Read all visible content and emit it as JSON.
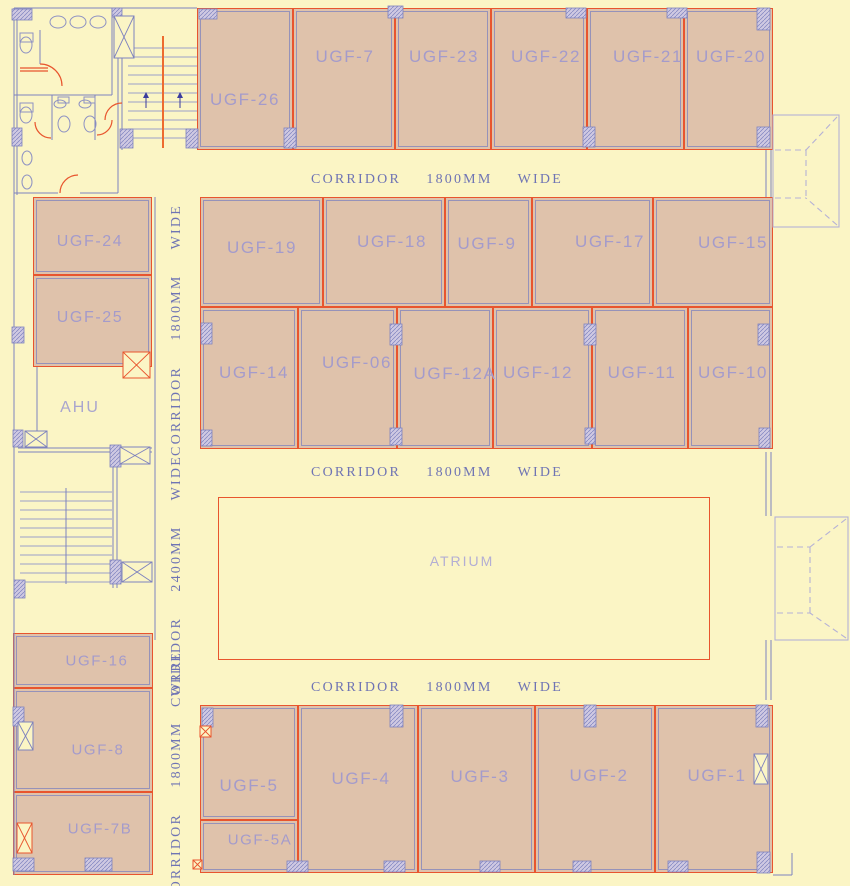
{
  "drawing": {
    "width": 850,
    "height": 886,
    "colors": {
      "background": "#FBF5C5",
      "room_fill": "#DFC2AB",
      "room_stroke": "#E8552E",
      "wall": "#7E82BE",
      "wall_faint": "rgba(126,130,190,0.75)",
      "tread": "#9B9EC9",
      "room_label": "#A49BCB",
      "corridor_label": "#6F74B4",
      "atrium_label": "#B3AED4",
      "ahu_label": "#A9A5CE",
      "column_fill": "#CFC9E2",
      "stair_center": "#ED6B2F",
      "arrow": "#3B3B9E",
      "canopy": "#B5B1D6",
      "fixture": "#8D91C3"
    },
    "rooms": [
      {
        "id": "ugf-26",
        "label": "UGF-26",
        "x": 197,
        "y": 8,
        "w": 96,
        "h": 142,
        "lx": 245,
        "ly": 100
      },
      {
        "id": "ugf-7",
        "label": "UGF-7",
        "x": 293,
        "y": 8,
        "w": 102,
        "h": 142,
        "lx": 345,
        "ly": 57
      },
      {
        "id": "ugf-23",
        "label": "UGF-23",
        "x": 395,
        "y": 8,
        "w": 96,
        "h": 142,
        "lx": 444,
        "ly": 57
      },
      {
        "id": "ugf-22",
        "label": "UGF-22",
        "x": 491,
        "y": 8,
        "w": 96,
        "h": 142,
        "lx": 546,
        "ly": 57
      },
      {
        "id": "ugf-21",
        "label": "UGF-21",
        "x": 587,
        "y": 8,
        "w": 97,
        "h": 142,
        "lx": 648,
        "ly": 57
      },
      {
        "id": "ugf-20",
        "label": "UGF-20",
        "x": 684,
        "y": 8,
        "w": 89,
        "h": 142,
        "lx": 731,
        "ly": 57
      },
      {
        "id": "ugf-19",
        "label": "UGF-19",
        "x": 200,
        "y": 197,
        "w": 123,
        "h": 110,
        "lx": 262,
        "ly": 248
      },
      {
        "id": "ugf-18",
        "label": "UGF-18",
        "x": 323,
        "y": 197,
        "w": 122,
        "h": 110,
        "lx": 392,
        "ly": 242
      },
      {
        "id": "ugf-9",
        "label": "UGF-9",
        "x": 445,
        "y": 197,
        "w": 87,
        "h": 110,
        "lx": 487,
        "ly": 244
      },
      {
        "id": "ugf-17",
        "label": "UGF-17",
        "x": 532,
        "y": 197,
        "w": 121,
        "h": 110,
        "lx": 610,
        "ly": 242
      },
      {
        "id": "ugf-15",
        "label": "UGF-15",
        "x": 653,
        "y": 197,
        "w": 120,
        "h": 110,
        "lx": 733,
        "ly": 243
      },
      {
        "id": "ugf-14",
        "label": "UGF-14",
        "x": 200,
        "y": 307,
        "w": 98,
        "h": 142,
        "lx": 254,
        "ly": 373
      },
      {
        "id": "ugf-06",
        "label": "UGF-06",
        "x": 298,
        "y": 307,
        "w": 99,
        "h": 142,
        "lx": 357,
        "ly": 363
      },
      {
        "id": "ugf-12a",
        "label": "UGF-12A",
        "x": 397,
        "y": 307,
        "w": 96,
        "h": 142,
        "lx": 455,
        "ly": 374
      },
      {
        "id": "ugf-12",
        "label": "UGF-12",
        "x": 493,
        "y": 307,
        "w": 99,
        "h": 142,
        "lx": 538,
        "ly": 373
      },
      {
        "id": "ugf-11",
        "label": "UGF-11",
        "x": 592,
        "y": 307,
        "w": 96,
        "h": 142,
        "lx": 642,
        "ly": 373
      },
      {
        "id": "ugf-10",
        "label": "UGF-10",
        "x": 688,
        "y": 307,
        "w": 85,
        "h": 142,
        "lx": 733,
        "ly": 373
      },
      {
        "id": "ugf-5",
        "label": "UGF-5",
        "x": 200,
        "y": 705,
        "w": 98,
        "h": 115,
        "lx": 249,
        "ly": 786
      },
      {
        "id": "ugf-5a",
        "label": "UGF-5A",
        "x": 200,
        "y": 820,
        "w": 98,
        "h": 53,
        "lx": 260,
        "ly": 840,
        "fs": 15
      },
      {
        "id": "ugf-4",
        "label": "UGF-4",
        "x": 298,
        "y": 705,
        "w": 120,
        "h": 168,
        "lx": 361,
        "ly": 779
      },
      {
        "id": "ugf-3",
        "label": "UGF-3",
        "x": 418,
        "y": 705,
        "w": 117,
        "h": 168,
        "lx": 480,
        "ly": 777
      },
      {
        "id": "ugf-2",
        "label": "UGF-2",
        "x": 535,
        "y": 705,
        "w": 120,
        "h": 168,
        "lx": 599,
        "ly": 776
      },
      {
        "id": "ugf-1",
        "label": "UGF-1",
        "x": 655,
        "y": 705,
        "w": 118,
        "h": 168,
        "lx": 717,
        "ly": 776
      },
      {
        "id": "ugf-24",
        "label": "UGF-24",
        "x": 33,
        "y": 197,
        "w": 119,
        "h": 78,
        "lx": 90,
        "ly": 242,
        "fs": 16
      },
      {
        "id": "ugf-25",
        "label": "UGF-25",
        "x": 33,
        "y": 275,
        "w": 119,
        "h": 92,
        "lx": 90,
        "ly": 318,
        "fs": 16
      },
      {
        "id": "ugf-16",
        "label": "UGF-16",
        "x": 13,
        "y": 633,
        "w": 140,
        "h": 55,
        "lx": 97,
        "ly": 661,
        "fs": 15
      },
      {
        "id": "ugf-8",
        "label": "UGF-8",
        "x": 13,
        "y": 688,
        "w": 140,
        "h": 104,
        "lx": 98,
        "ly": 750,
        "fs": 15
      },
      {
        "id": "ugf-7b",
        "label": "UGF-7B",
        "x": 13,
        "y": 792,
        "w": 140,
        "h": 83,
        "lx": 100,
        "ly": 829,
        "fs": 15
      }
    ],
    "open_areas": [
      {
        "id": "ahu",
        "label": "AHU",
        "lx": 80,
        "ly": 408,
        "fs": 16,
        "color_key": "ahu_label"
      },
      {
        "id": "atrium",
        "label": "ATRIUM",
        "x": 218,
        "y": 497,
        "w": 492,
        "h": 163,
        "lx": 462,
        "ly": 561,
        "fs": 14,
        "color_key": "atrium_label"
      }
    ],
    "corridor_labels": [
      {
        "id": "corridor-top",
        "text": "CORRIDOR  1800MM  WIDE",
        "x": 437,
        "y": 180,
        "vertical": false
      },
      {
        "id": "corridor-middle",
        "text": "CORRIDOR  1800MM  WIDE",
        "x": 437,
        "y": 473,
        "vertical": false
      },
      {
        "id": "corridor-bottom",
        "text": "CORRIDOR  1800MM  WIDE",
        "x": 437,
        "y": 688,
        "vertical": false
      },
      {
        "id": "corridor-left-upper",
        "text": "CORRIDOR  1800MM  WIDE",
        "x": 177,
        "y": 330,
        "vertical": true
      },
      {
        "id": "corridor-left-middle",
        "text": "CORRIDOR  2400MM  WIDE",
        "x": 177,
        "y": 581,
        "vertical": true
      },
      {
        "id": "corridor-left-lower",
        "text": "CORRIDOR  1800MM  WIDE",
        "x": 177,
        "y": 777,
        "vertical": true
      }
    ],
    "walls": [
      [
        14,
        8,
        14,
        875
      ],
      [
        17,
        8,
        17,
        195
      ],
      [
        14,
        8,
        197,
        8
      ],
      [
        40,
        30,
        40,
        64
      ],
      [
        14,
        95,
        112,
        95
      ],
      [
        52,
        95,
        52,
        140
      ],
      [
        95,
        95,
        95,
        140
      ],
      [
        112,
        8,
        112,
        95
      ],
      [
        14,
        193,
        58,
        193
      ],
      [
        80,
        193,
        118,
        193
      ],
      [
        118,
        30,
        118,
        193
      ],
      [
        122,
        30,
        122,
        150
      ],
      [
        37,
        367,
        37,
        448
      ],
      [
        155,
        197,
        155,
        640
      ],
      [
        18,
        448,
        152,
        448
      ],
      [
        18,
        452,
        152,
        452
      ],
      [
        113,
        452,
        113,
        588
      ],
      [
        117,
        452,
        117,
        588
      ],
      [
        766,
        150,
        766,
        197
      ],
      [
        771,
        150,
        771,
        197
      ],
      [
        766,
        452,
        766,
        516
      ],
      [
        771,
        452,
        771,
        516
      ],
      [
        766,
        640,
        766,
        700
      ],
      [
        771,
        640,
        771,
        700
      ],
      [
        773,
        875,
        792,
        875
      ],
      [
        792,
        853,
        792,
        875
      ]
    ],
    "orange_lines": [
      [
        20,
        68,
        48,
        68
      ],
      [
        20,
        71,
        48,
        71
      ]
    ],
    "door_arcs": [
      "M40,64 A22,22 0 0 1 62,86",
      "M35,122 A16,16 0 0 0 51,138",
      "M112,120 A15,15 0 0 1 97,135",
      "M60,193 A18,18 0 0 1 78,175",
      "M122,103 A17,17 0 0 0 105,120"
    ],
    "stairs": [
      {
        "x1": 128,
        "x2": 197,
        "y1": 48,
        "y2": 138,
        "n": 11,
        "cx": 163,
        "cy1": 36,
        "cy2": 148,
        "center": "stair_center",
        "cw": 2
      },
      {
        "x1": 20,
        "x2": 112,
        "y1": 492,
        "y2": 582,
        "n": 11,
        "cx": 66,
        "cy1": 488,
        "cy2": 584,
        "center": "wall",
        "cw": 1
      }
    ],
    "arrows": [
      [
        146,
        108,
        92
      ],
      [
        180,
        108,
        92
      ]
    ],
    "fixtures": {
      "ellipses": [
        [
          58,
          22,
          8,
          6
        ],
        [
          78,
          22,
          8,
          6
        ],
        [
          98,
          22,
          8,
          6
        ],
        [
          26,
          45,
          6,
          8
        ],
        [
          26,
          115,
          6,
          8
        ],
        [
          60,
          104,
          6,
          4
        ],
        [
          85,
          104,
          6,
          4
        ],
        [
          64,
          124,
          6,
          8
        ],
        [
          90,
          124,
          6,
          8
        ],
        [
          27,
          158,
          5,
          7
        ],
        [
          27,
          182,
          5,
          7
        ]
      ],
      "rects": [
        [
          20,
          33,
          13,
          9
        ],
        [
          20,
          103,
          13,
          9
        ],
        [
          58,
          97,
          11,
          6
        ],
        [
          84,
          97,
          11,
          6
        ]
      ]
    },
    "columns": [
      [
        199,
        9,
        18,
        10
      ],
      [
        388,
        6,
        15,
        12
      ],
      [
        566,
        8,
        20,
        10
      ],
      [
        667,
        8,
        20,
        10
      ],
      [
        757,
        8,
        13,
        22
      ],
      [
        284,
        128,
        12,
        20
      ],
      [
        583,
        127,
        12,
        20
      ],
      [
        757,
        127,
        13,
        20
      ],
      [
        120,
        129,
        13,
        19
      ],
      [
        186,
        129,
        12,
        19
      ],
      [
        12,
        9,
        20,
        11
      ],
      [
        112,
        8,
        10,
        9
      ],
      [
        12,
        128,
        10,
        18
      ],
      [
        12,
        327,
        12,
        16
      ],
      [
        201,
        323,
        11,
        21
      ],
      [
        390,
        324,
        12,
        21
      ],
      [
        584,
        324,
        12,
        21
      ],
      [
        758,
        324,
        11,
        21
      ],
      [
        201,
        430,
        11,
        16
      ],
      [
        390,
        428,
        12,
        17
      ],
      [
        585,
        428,
        10,
        16
      ],
      [
        759,
        428,
        11,
        20
      ],
      [
        13,
        430,
        10,
        17
      ],
      [
        110,
        445,
        11,
        22
      ],
      [
        110,
        560,
        11,
        24
      ],
      [
        14,
        580,
        11,
        18
      ],
      [
        13,
        707,
        11,
        19
      ],
      [
        13,
        858,
        21,
        13
      ],
      [
        85,
        858,
        27,
        13
      ],
      [
        202,
        708,
        11,
        19
      ],
      [
        390,
        705,
        13,
        22
      ],
      [
        584,
        705,
        12,
        22
      ],
      [
        756,
        705,
        12,
        22
      ],
      [
        287,
        861,
        21,
        11
      ],
      [
        384,
        861,
        21,
        11
      ],
      [
        480,
        861,
        20,
        11
      ],
      [
        573,
        861,
        18,
        11
      ],
      [
        668,
        861,
        20,
        11
      ],
      [
        757,
        852,
        13,
        21
      ]
    ],
    "xboxes": [
      [
        114,
        16,
        20,
        42,
        "wall"
      ],
      [
        123,
        352,
        27,
        26,
        "accent"
      ],
      [
        25,
        431,
        22,
        16,
        "wall"
      ],
      [
        120,
        447,
        30,
        17,
        "wall"
      ],
      [
        122,
        562,
        30,
        20,
        "wall"
      ],
      [
        18,
        722,
        15,
        28,
        "wall"
      ],
      [
        17,
        823,
        15,
        30,
        "accent"
      ],
      [
        754,
        754,
        14,
        30,
        "wall"
      ],
      [
        200,
        726,
        11,
        11,
        "accent"
      ],
      [
        193,
        860,
        9,
        9,
        "accent"
      ]
    ],
    "canopies": [
      {
        "x": 773,
        "y": 115,
        "w": 66,
        "h": 112,
        "ix": 806,
        "iy1": 150,
        "iy2": 198
      },
      {
        "x": 775,
        "y": 517,
        "w": 73,
        "h": 123,
        "ix": 810,
        "iy1": 547,
        "iy2": 613
      }
    ]
  }
}
